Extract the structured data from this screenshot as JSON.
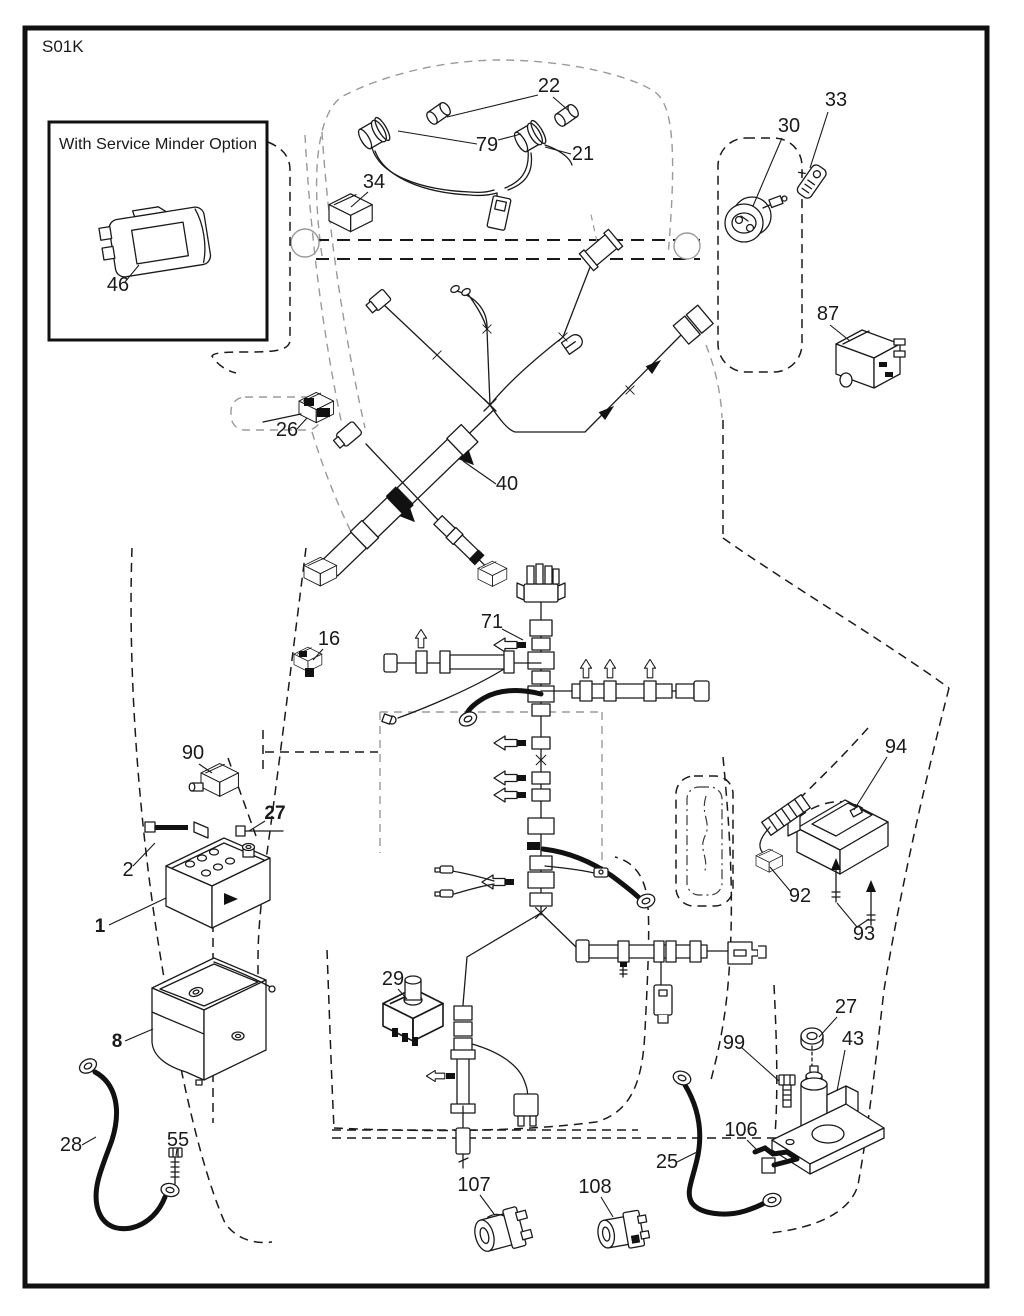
{
  "page": {
    "code": "S01K"
  },
  "inset": {
    "title": "With Service Minder Option"
  },
  "colors": {
    "line": "#1a1a1a",
    "muted": "#9a9a9a",
    "paper": "#ffffff"
  },
  "labels": [
    {
      "text": "22",
      "x": 549,
      "y": 92,
      "bold": false
    },
    {
      "text": "33",
      "x": 836,
      "y": 106,
      "bold": false
    },
    {
      "text": "30",
      "x": 789,
      "y": 132,
      "bold": false
    },
    {
      "text": "79",
      "x": 487,
      "y": 151,
      "bold": false
    },
    {
      "text": "21",
      "x": 583,
      "y": 160,
      "bold": false
    },
    {
      "text": "34",
      "x": 374,
      "y": 188,
      "bold": false
    },
    {
      "text": "46",
      "x": 118,
      "y": 291,
      "bold": false
    },
    {
      "text": "87",
      "x": 828,
      "y": 320,
      "bold": false
    },
    {
      "text": "26",
      "x": 287,
      "y": 436,
      "bold": false
    },
    {
      "text": "40",
      "x": 507,
      "y": 490,
      "bold": false
    },
    {
      "text": "71",
      "x": 492,
      "y": 628,
      "bold": false
    },
    {
      "text": "16",
      "x": 329,
      "y": 645,
      "bold": false
    },
    {
      "text": "90",
      "x": 193,
      "y": 759,
      "bold": false
    },
    {
      "text": "94",
      "x": 896,
      "y": 753,
      "bold": false
    },
    {
      "text": "27",
      "x": 275,
      "y": 819,
      "bold": true
    },
    {
      "text": "2",
      "x": 128,
      "y": 876,
      "bold": false
    },
    {
      "text": "92",
      "x": 800,
      "y": 902,
      "bold": false
    },
    {
      "text": "1",
      "x": 100,
      "y": 932,
      "bold": true
    },
    {
      "text": "93",
      "x": 864,
      "y": 940,
      "bold": false
    },
    {
      "text": "29",
      "x": 393,
      "y": 985,
      "bold": false
    },
    {
      "text": "27",
      "x": 846,
      "y": 1013,
      "bold": false
    },
    {
      "text": "8",
      "x": 117,
      "y": 1047,
      "bold": true
    },
    {
      "text": "99",
      "x": 734,
      "y": 1049,
      "bold": false
    },
    {
      "text": "43",
      "x": 853,
      "y": 1045,
      "bold": false
    },
    {
      "text": "106",
      "x": 741,
      "y": 1136,
      "bold": false
    },
    {
      "text": "28",
      "x": 71,
      "y": 1151,
      "bold": false
    },
    {
      "text": "55",
      "x": 178,
      "y": 1146,
      "bold": false
    },
    {
      "text": "25",
      "x": 667,
      "y": 1168,
      "bold": false
    },
    {
      "text": "107",
      "x": 474,
      "y": 1191,
      "bold": false
    },
    {
      "text": "108",
      "x": 595,
      "y": 1193,
      "bold": false
    }
  ]
}
